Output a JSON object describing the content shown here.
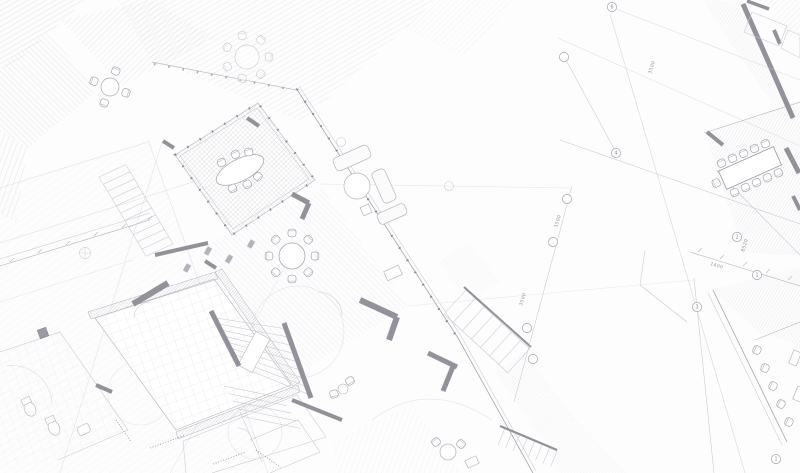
{
  "drawing": {
    "background": "#fdfdfe",
    "colors": {
      "hatch_light": "#dcdce1",
      "hatch_mid": "#cfcfd6",
      "line_light": "#c9c9d0",
      "line_mid": "#a5a5ae",
      "line_dark": "#8f8f97",
      "wall_fill": "#9a9aa3",
      "label_text": "#93939c"
    }
  },
  "grid_bubbles": [
    {
      "label": "6",
      "x": 612,
      "y": 7
    },
    {
      "label": "",
      "x": 564,
      "y": 57
    },
    {
      "label": "4",
      "x": 616,
      "y": 153
    },
    {
      "label": "",
      "x": 567,
      "y": 199
    },
    {
      "label": "",
      "x": 553,
      "y": 242
    },
    {
      "label": "2",
      "x": 737,
      "y": 237
    },
    {
      "label": "1",
      "x": 757,
      "y": 275
    },
    {
      "label": "3",
      "x": 697,
      "y": 307
    },
    {
      "label": "",
      "x": 527,
      "y": 328
    },
    {
      "label": "",
      "x": 533,
      "y": 359
    },
    {
      "label": "1",
      "x": 776,
      "y": 459
    }
  ],
  "dimension_labels": [
    {
      "text": "3500",
      "x": 651,
      "y": 74,
      "rotate": -73
    },
    {
      "text": "3500",
      "x": 557,
      "y": 228,
      "rotate": -73
    },
    {
      "text": "3500",
      "x": 522,
      "y": 306,
      "rotate": -73
    },
    {
      "text": "8520",
      "x": 744,
      "y": 252,
      "rotate": -73
    },
    {
      "text": "1400",
      "x": 710,
      "y": 265,
      "rotate": 17
    }
  ]
}
